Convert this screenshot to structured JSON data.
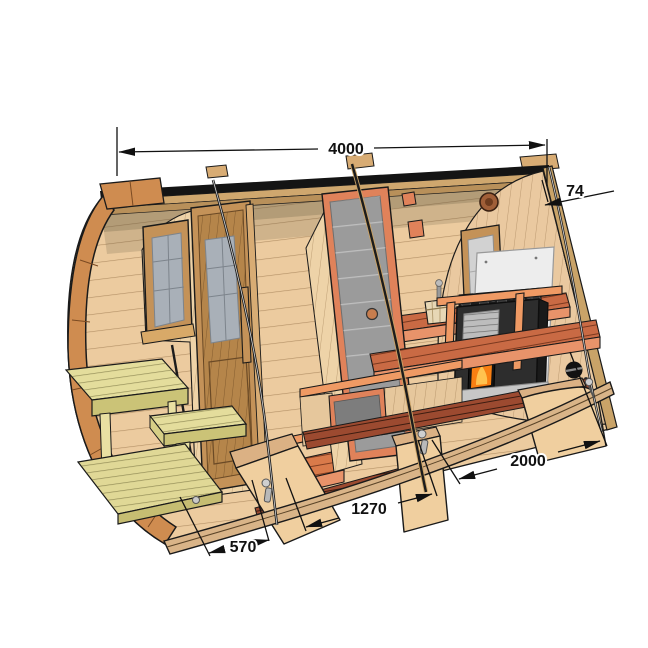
{
  "diagram": {
    "type": "barrel-sauna-cutaway",
    "dimensions": {
      "overall_length": {
        "label": "4000"
      },
      "wall_thickness": {
        "label": "74"
      },
      "sauna_room": {
        "label": "2000"
      },
      "rest_room": {
        "label": "1270"
      },
      "terrace": {
        "label": "570"
      }
    },
    "palette": {
      "background": "#ffffff",
      "wood_light": "#eccb9f",
      "rim_trim": "#cf8c50",
      "bench_orange": "#e8936a",
      "bench_slat": "#c96a44",
      "terrace_bench": "#e4dd9c",
      "floor_dark": "#9c4a30",
      "roof_black": "#141414",
      "stove_black": "#2d2d2d",
      "fire_orange": "#f97f12",
      "heat_shield": "#ededed",
      "glass_gray": "#9b9b9b",
      "dimension_ink": "#111111"
    }
  }
}
